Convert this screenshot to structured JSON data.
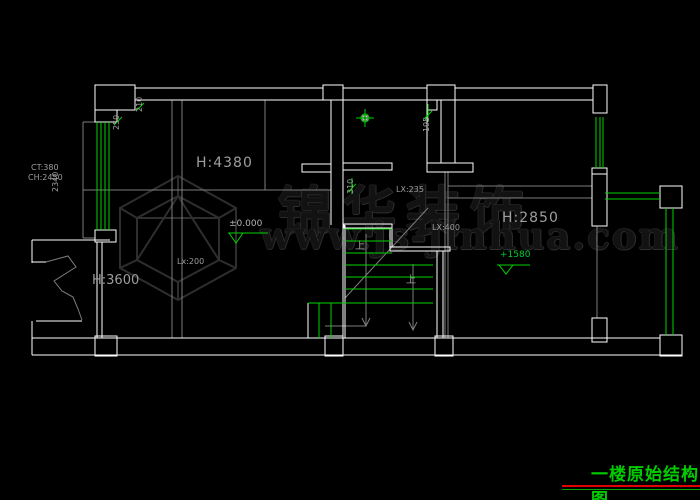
{
  "colors": {
    "bg": "#000000",
    "wall": "#ffffff",
    "window_green": "#00d400",
    "gray_line": "#7d7d7d",
    "annotation_gray": "#9e9e9e",
    "title_green": "#00cc00",
    "line_red": "#e00000",
    "line_green": "#00a800",
    "elev_green": "#00cc33",
    "watermark_dark": "#2f2f2f"
  },
  "watermark": {
    "brand": "锦华装饰",
    "website": "www.js-jinhua.com"
  },
  "rooms": {
    "living": {
      "height": "H:4380"
    },
    "left": {
      "height": "H:3600"
    },
    "right": {
      "height": "H:2850"
    }
  },
  "window_note": {
    "ct": "CT:380",
    "ch": "CH:2450"
  },
  "dimensions": {
    "d2340": "2340",
    "d250": "250",
    "d210": "210",
    "d195": "195",
    "d310": "310"
  },
  "beams": {
    "lx200": "Lx:200",
    "lx235": "LX:235",
    "lx400": "LX:400"
  },
  "elevations": {
    "ground": "±0.000",
    "landing": "+1580"
  },
  "stairs": {
    "up1": "上",
    "up2": "上"
  },
  "title_block": {
    "title": "一楼原始结构图"
  }
}
